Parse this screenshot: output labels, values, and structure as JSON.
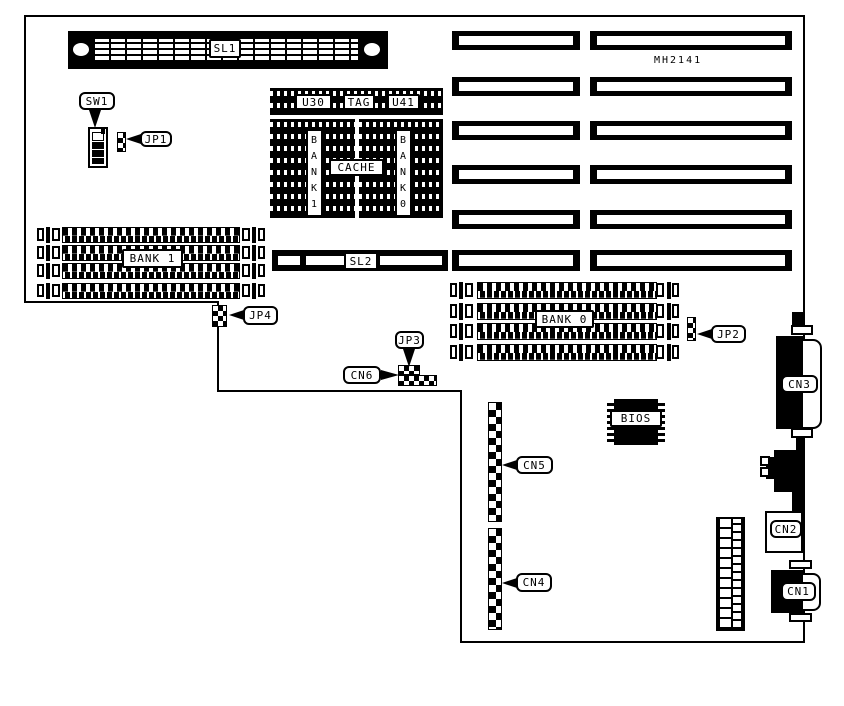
{
  "diagram": {
    "part_number": "MH2141",
    "colors": {
      "ink": "#000000",
      "paper": "#ffffff"
    },
    "slots": {
      "sl1": "SL1",
      "sl2": "SL2"
    },
    "memory": {
      "bank1": "BANK 1",
      "bank0": "BANK 0"
    },
    "cache_area": {
      "u30": "U30",
      "tag": "TAG",
      "u41": "U41",
      "cache": "CACHE",
      "bank1_vertical": "B\nA\nN\nK\n1",
      "bank0_vertical": "B\nA\nN\nK\n0"
    },
    "bios": "BIOS",
    "callouts": {
      "sw1": "SW1",
      "jp1": "JP1",
      "jp2": "JP2",
      "jp3": "JP3",
      "jp4": "JP4",
      "cn1": "CN1",
      "cn2": "CN2",
      "cn3": "CN3",
      "cn4": "CN4",
      "cn5": "CN5",
      "cn6": "CN6"
    }
  }
}
